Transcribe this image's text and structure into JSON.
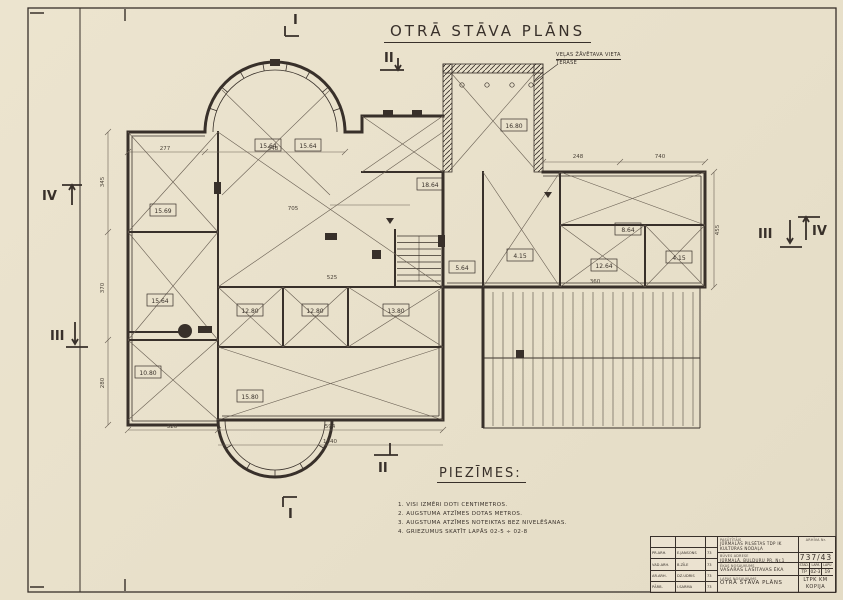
{
  "page": {
    "title": "OTRĀ STĀVA PLĀNS",
    "paper_color": "#e9e1cc",
    "ink_color": "#38302a"
  },
  "annotation": {
    "line1": "VEĻAS ŽĀVĒTAVA VIETA",
    "line2": "TERASE"
  },
  "notes": {
    "heading": "PIEZĪMES:",
    "items": [
      "1. VISI IZMĒRI DOTI CENTIMETROS.",
      "2. AUGSTUMA ATZĪMES DOTAS METROS.",
      "3. AUGSTUMA ATZĪMES NOTEIKTAS BEZ NIVELĒŠANAS.",
      "4. GRIEZUMUS SKATĪT LAPĀS 02-5 ÷ 02-8"
    ]
  },
  "markers": {
    "i": "I",
    "ii": "II",
    "iii": "III",
    "iv": "IV"
  },
  "plan": {
    "rooms": [
      "15.64",
      "15.64",
      "15.69",
      "15.64",
      "10.80",
      "12.80",
      "12.80",
      "13.80",
      "15.80",
      "18.64",
      "16.80",
      "4.15",
      "5.64",
      "12.64",
      "4.15",
      "8.64"
    ],
    "dims": [
      "277",
      "548",
      "345",
      "370",
      "280",
      "705",
      "525",
      "248",
      "740",
      "360",
      "594",
      "320",
      "455",
      "1040"
    ]
  },
  "title_block": {
    "client_label": "PASŪTĪTĀJS",
    "client": "JŪRMALAS PILSĒTAS TDP IK KULTŪRAS NODAĻA",
    "address_label": "BŪVES ADRESE",
    "address": "JŪRMALĀ, BULDURU PR. Nr.1",
    "building_label": "ĒKAS NOSAUKUMS",
    "building": "VASARAS LASĪTAVAS ĒKA",
    "sheet_label": "LAPAS NOSAUKUMS",
    "sheet": "OTRĀ STĀVA PLĀNS",
    "archive_label": "ARHĪVA Nr.",
    "archive_no": "737/43",
    "stage_label": "STAD.",
    "stage": "TP",
    "page_label": "LAPA",
    "page_no": "02-3",
    "pages_label": "LAPU",
    "pages": "19",
    "org": "LTPK KM KOPIJA",
    "signatures": [
      {
        "role": "PR.ARH.",
        "name": "E.JANSONS",
        "year": "73"
      },
      {
        "role": "VAD.ARH.",
        "name": "B.ZĪLE",
        "year": "73"
      },
      {
        "role": "AR.ARH.",
        "name": "DZ.UDRIS",
        "year": "73"
      },
      {
        "role": "PĀRB.",
        "name": "I.SARMA",
        "year": "73"
      }
    ]
  }
}
